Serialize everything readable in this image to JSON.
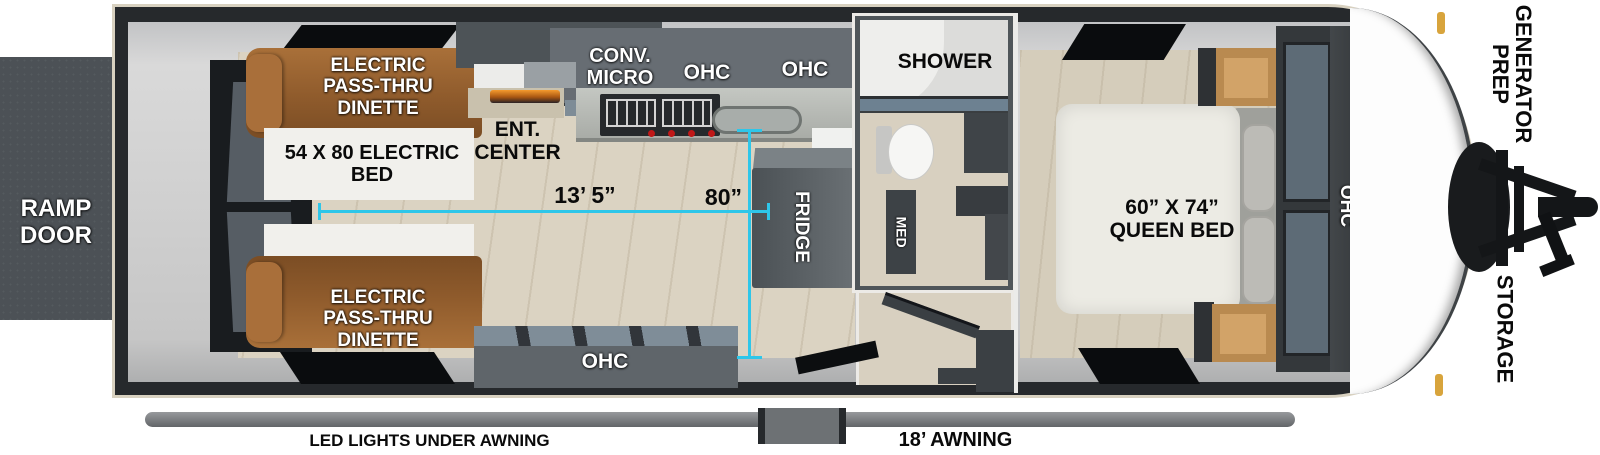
{
  "title": "Toy hauler travel trailer floorplan",
  "colors": {
    "dimension_line": "#2EC6E9",
    "dinette_wood": "#8F5B2C",
    "cabinet_gray": "#5F656A",
    "floor_beige": "#DAD3C3",
    "ramp_door_gray": "#4C5156",
    "accent_gold": "#D8A43C"
  },
  "exterior": {
    "ramp_door": "RAMP DOOR",
    "generator_prep": "GENERATOR PREP",
    "storage": "STORAGE",
    "awning_length": "18’ AWNING",
    "led_lights": "LED LIGHTS UNDER AWNING"
  },
  "garage": {
    "dinette_top": "ELECTRIC PASS-THRU DINETTE",
    "dinette_bottom": "ELECTRIC PASS-THRU DINETTE",
    "electric_bed": "54 X 80 ELECTRIC BED",
    "ent_center": "ENT. CENTER"
  },
  "kitchen": {
    "conv_micro": "CONV. MICRO",
    "ohc_left": "OHC",
    "ohc_right": "OHC",
    "ohc_lower": "OHC",
    "fridge": "FRIDGE"
  },
  "bath": {
    "shower": "SHOWER",
    "med": "MED"
  },
  "bedroom": {
    "queen_bed": "60” X 74” QUEEN BED",
    "ohc": "OHC"
  },
  "dimensions": {
    "interior_length": "13’ 5”",
    "interior_width": "80”"
  }
}
